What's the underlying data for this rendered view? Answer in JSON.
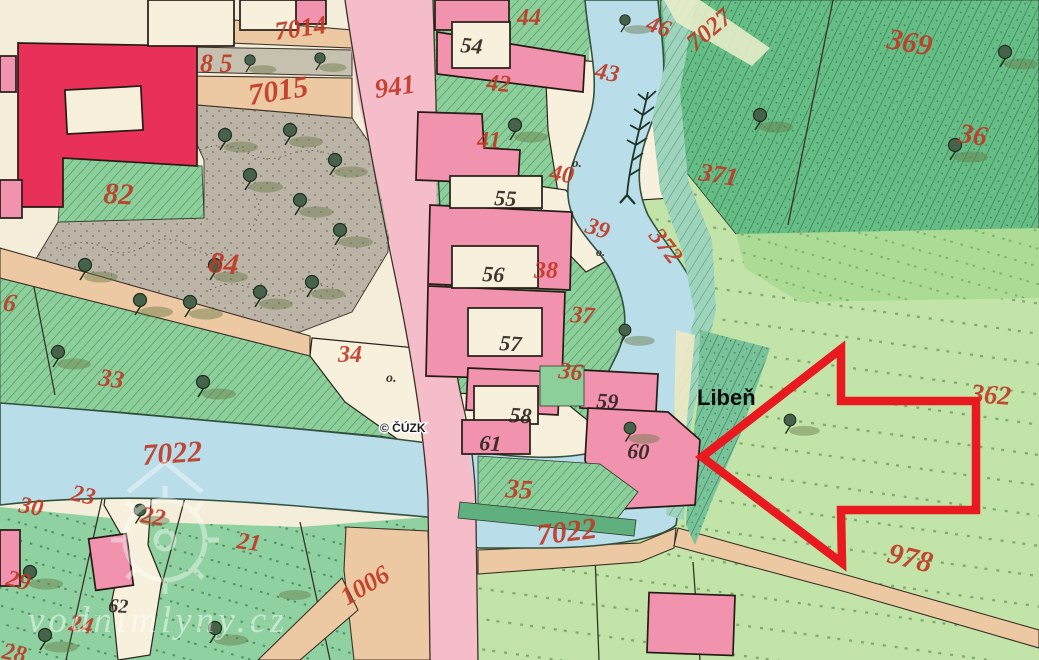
{
  "map": {
    "place_label": "Libeň",
    "copyright": "© ČÚZK",
    "watermark": "vodnimlyny.cz",
    "arrow": {
      "points": "702,457 841,349 841,401 976,401 976,510 841,510 842,563",
      "color": "#e8191f"
    },
    "palette": {
      "paper": "#f3edda",
      "water": "#b9dde9",
      "road_pink": "#f5bcca",
      "building_pink": "#f192ae",
      "building_red": "#e93059",
      "road_tan": "#ecc9a2",
      "field_light": "#c2e4a9",
      "garden_green": "#8ccf9a",
      "forest_green": "#66bd85",
      "park_grey": "#bcb5a7",
      "ink_red": "#c13a26",
      "ink_black": "#2a231d"
    },
    "parcel_numbers_red": [
      {
        "text": "7014",
        "x": 276,
        "y": 40,
        "rot": -8,
        "size": 26
      },
      {
        "text": "8 5",
        "x": 200,
        "y": 72,
        "rot": 0,
        "size": 26
      },
      {
        "text": "7015",
        "x": 250,
        "y": 105,
        "rot": -9,
        "size": 30
      },
      {
        "text": "941",
        "x": 376,
        "y": 98,
        "rot": -8,
        "size": 27
      },
      {
        "text": "44",
        "x": 517,
        "y": 25,
        "rot": 0,
        "size": 24
      },
      {
        "text": "46",
        "x": 645,
        "y": 30,
        "rot": 18,
        "size": 24
      },
      {
        "text": "42",
        "x": 486,
        "y": 90,
        "rot": 5,
        "size": 24
      },
      {
        "text": "43",
        "x": 594,
        "y": 78,
        "rot": 10,
        "size": 24
      },
      {
        "text": "41",
        "x": 477,
        "y": 148,
        "rot": 0,
        "size": 24
      },
      {
        "text": "40",
        "x": 549,
        "y": 180,
        "rot": 8,
        "size": 24
      },
      {
        "text": "39",
        "x": 584,
        "y": 232,
        "rot": 18,
        "size": 24
      },
      {
        "text": "38",
        "x": 534,
        "y": 278,
        "rot": 0,
        "size": 24
      },
      {
        "text": "372",
        "x": 648,
        "y": 236,
        "rot": 52,
        "size": 25
      },
      {
        "text": "37",
        "x": 570,
        "y": 322,
        "rot": 4,
        "size": 24
      },
      {
        "text": "36",
        "x": 558,
        "y": 378,
        "rot": 6,
        "size": 24
      },
      {
        "text": "35",
        "x": 505,
        "y": 497,
        "rot": 4,
        "size": 27
      },
      {
        "text": "34",
        "x": 338,
        "y": 362,
        "rot": 0,
        "size": 24
      },
      {
        "text": "33",
        "x": 98,
        "y": 385,
        "rot": 8,
        "size": 25
      },
      {
        "text": "6",
        "x": 2,
        "y": 310,
        "rot": 10,
        "size": 26
      },
      {
        "text": "84",
        "x": 208,
        "y": 272,
        "rot": 5,
        "size": 30
      },
      {
        "text": "82",
        "x": 103,
        "y": 203,
        "rot": 3,
        "size": 30
      },
      {
        "text": "7022",
        "x": 143,
        "y": 465,
        "rot": -4,
        "size": 30
      },
      {
        "text": "7022",
        "x": 538,
        "y": 545,
        "rot": -7,
        "size": 30
      },
      {
        "text": "1006",
        "x": 347,
        "y": 606,
        "rot": -31,
        "size": 26
      },
      {
        "text": "978",
        "x": 886,
        "y": 562,
        "rot": 14,
        "size": 30
      },
      {
        "text": "369",
        "x": 886,
        "y": 48,
        "rot": 10,
        "size": 30
      },
      {
        "text": "371",
        "x": 698,
        "y": 180,
        "rot": 9,
        "size": 26
      },
      {
        "text": "7027",
        "x": 695,
        "y": 52,
        "rot": -40,
        "size": 25
      },
      {
        "text": "36",
        "x": 958,
        "y": 142,
        "rot": 8,
        "size": 28
      },
      {
        "text": "362",
        "x": 970,
        "y": 402,
        "rot": 4,
        "size": 27
      },
      {
        "text": "30",
        "x": 18,
        "y": 512,
        "rot": 10,
        "size": 24
      },
      {
        "text": "23",
        "x": 70,
        "y": 500,
        "rot": 12,
        "size": 24
      },
      {
        "text": "22",
        "x": 140,
        "y": 522,
        "rot": 10,
        "size": 24
      },
      {
        "text": "21",
        "x": 236,
        "y": 548,
        "rot": 8,
        "size": 24
      },
      {
        "text": "29",
        "x": 5,
        "y": 585,
        "rot": 14,
        "size": 24
      },
      {
        "text": "24",
        "x": 68,
        "y": 630,
        "rot": 10,
        "size": 24
      },
      {
        "text": "28",
        "x": 1,
        "y": 658,
        "rot": 12,
        "size": 24
      }
    ],
    "house_numbers_black": [
      {
        "text": "54",
        "x": 460,
        "y": 52,
        "rot": 5,
        "size": 22
      },
      {
        "text": "55",
        "x": 494,
        "y": 205,
        "rot": 3,
        "size": 22
      },
      {
        "text": "56",
        "x": 482,
        "y": 281,
        "rot": 3,
        "size": 22
      },
      {
        "text": "57",
        "x": 499,
        "y": 350,
        "rot": 4,
        "size": 22
      },
      {
        "text": "58",
        "x": 509,
        "y": 422,
        "rot": 4,
        "size": 22
      },
      {
        "text": "59",
        "x": 596,
        "y": 408,
        "rot": 3,
        "size": 22
      },
      {
        "text": "60",
        "x": 627,
        "y": 458,
        "rot": 3,
        "size": 22
      },
      {
        "text": "61",
        "x": 479,
        "y": 450,
        "rot": 3,
        "size": 22
      },
      {
        "text": "62",
        "x": 108,
        "y": 612,
        "rot": 3,
        "size": 20
      },
      {
        "text": "o.",
        "x": 386,
        "y": 382,
        "rot": 0,
        "size": 14
      },
      {
        "text": "o.",
        "x": 572,
        "y": 167,
        "rot": 0,
        "size": 13
      },
      {
        "text": "o.",
        "x": 596,
        "y": 256,
        "rot": 0,
        "size": 12
      }
    ]
  }
}
